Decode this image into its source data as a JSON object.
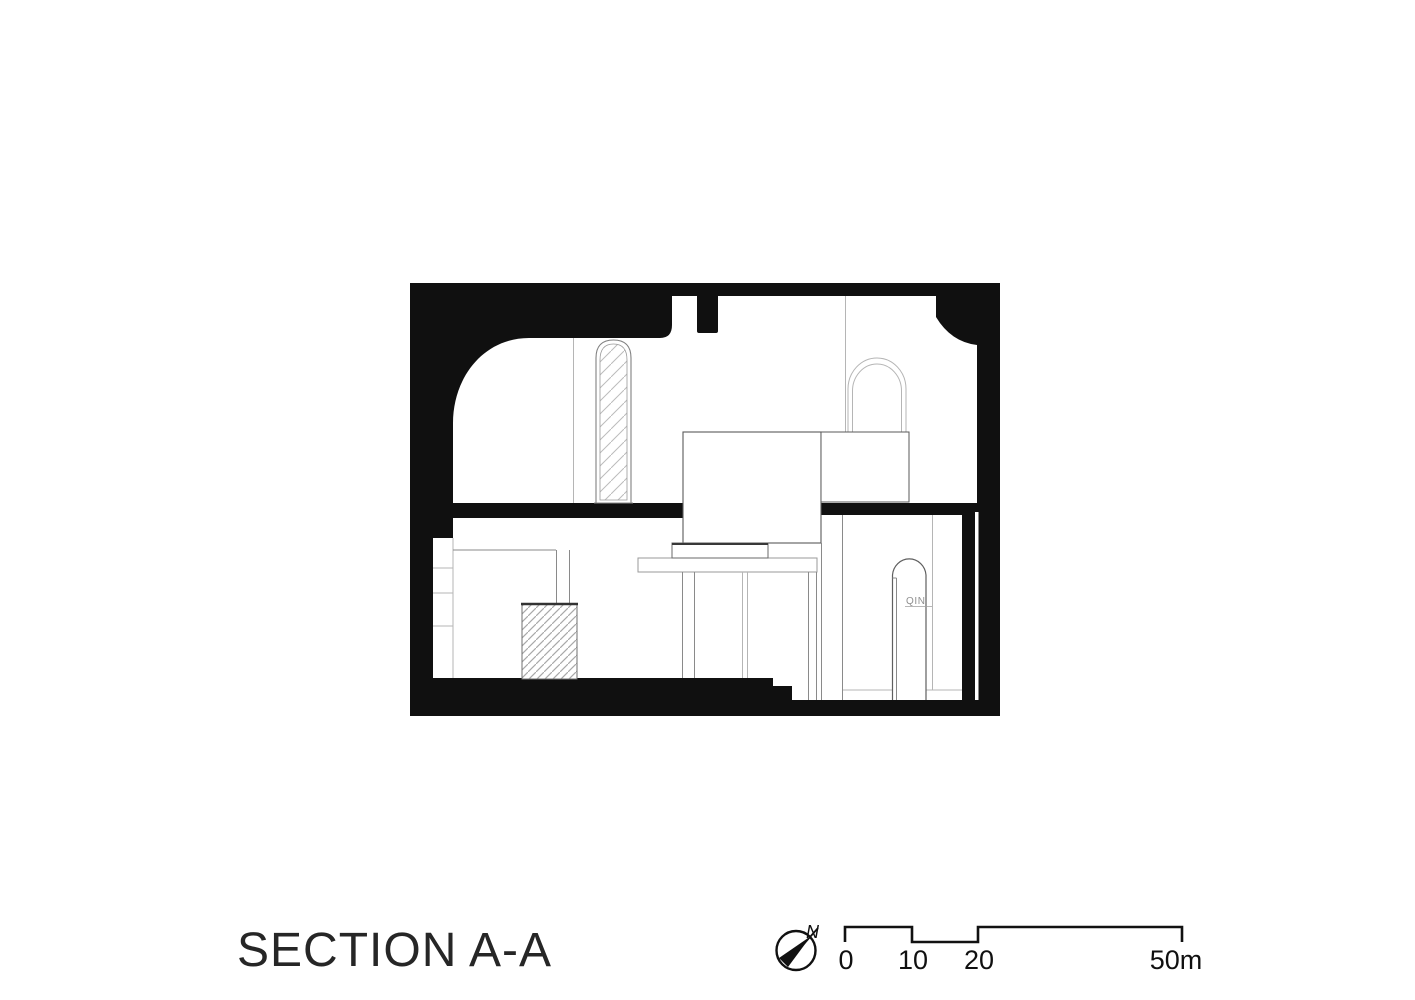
{
  "title": {
    "label": "SECTION A-A"
  },
  "drawing": {
    "door_logo_text": "QIN"
  },
  "compass": {
    "north_label": "N"
  },
  "scale_bar": {
    "tick_0": "0",
    "tick_10": "10",
    "tick_20": "20",
    "tick_50": "50m",
    "units": "meters"
  },
  "colors": {
    "ink": "#101010",
    "title_ink": "#262626",
    "line_light": "#b5b5b5",
    "line_mid": "#8a8a8a",
    "line_dark": "#555555",
    "paper": "#ffffff"
  }
}
